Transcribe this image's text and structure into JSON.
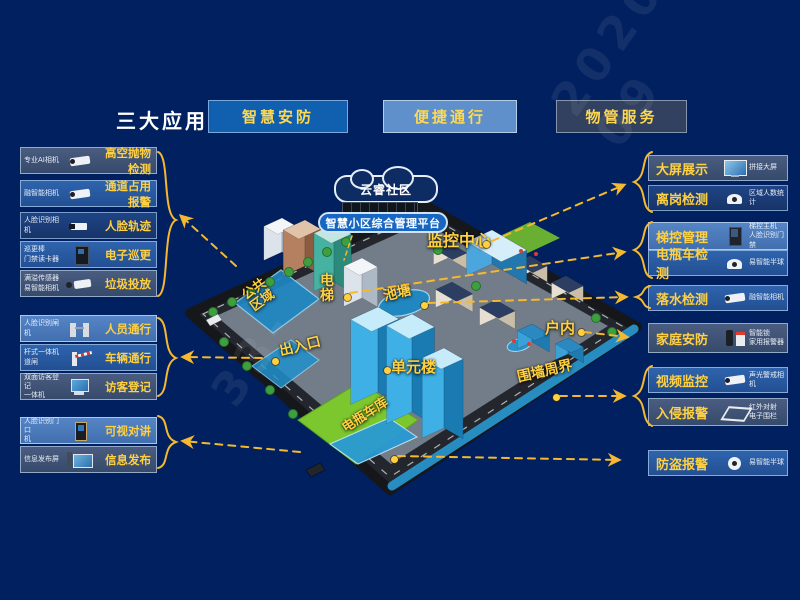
{
  "title": "三大应用",
  "buttons": [
    "智慧安防",
    "便捷通行",
    "物管服务"
  ],
  "left_items": [
    {
      "device": "专业AI相机",
      "label": "高空抛物检测",
      "icon": "bullet-camera"
    },
    {
      "device": "融智能相机",
      "label": "通道占用报警",
      "icon": "bullet-camera"
    },
    {
      "device": "人脸识别相机",
      "label": "人脸轨迹",
      "icon": "box-camera"
    },
    {
      "device": "巡更棒\n门禁读卡器",
      "label": "电子巡更",
      "icon": "card-reader"
    },
    {
      "device": "满溢传感器\n易智能相机",
      "label": "垃圾投放",
      "icon": "sensor-camera"
    },
    {
      "device": "人脸识别闸机",
      "label": "人员通行",
      "icon": "turnstile"
    },
    {
      "device": "杆式一体机\n道闸",
      "label": "车辆通行",
      "icon": "barrier-gate"
    },
    {
      "device": "双面访客登记\n一体机",
      "label": "访客登记",
      "icon": "visitor-terminal"
    },
    {
      "device": "人脸识别门口\n机",
      "label": "可视对讲",
      "icon": "door-station"
    },
    {
      "device": "信息发布屏",
      "label": "信息发布",
      "icon": "info-screen"
    }
  ],
  "right_items": [
    {
      "label": "大屏展示",
      "device": "拼接大屏",
      "icon": "video-wall"
    },
    {
      "label": "离岗检测",
      "device": "区域人数统计",
      "icon": "dome-camera"
    },
    {
      "label": "梯控管理",
      "device": "梯控主机\n人脸识别门禁",
      "icon": "access-panel"
    },
    {
      "label": "电瓶车检测",
      "device": "易智能半球",
      "icon": "dome-camera"
    },
    {
      "label": "落水检测",
      "device": "融智能相机",
      "icon": "bullet-camera"
    },
    {
      "label": "家庭安防",
      "device": "智能锁\n家用报警器",
      "icon": "smart-lock"
    },
    {
      "label": "视频监控",
      "device": "声光警戒相机",
      "icon": "bullet-camera"
    },
    {
      "label": "入侵报警",
      "device": "红外对射\n电子围栏",
      "icon": "fence"
    },
    {
      "label": "防盗报警",
      "device": "易智能半球",
      "icon": "turret-camera"
    }
  ],
  "map": {
    "cloud_label": "云睿社区",
    "platform_label": "智慧小区综合管理平台",
    "zones": [
      {
        "key": "jk",
        "text": "监控中心"
      },
      {
        "key": "dt",
        "text": "电梯"
      },
      {
        "key": "ct",
        "text": "池塘"
      },
      {
        "key": "gg",
        "text": "公共\n区域"
      },
      {
        "key": "crk",
        "text": "出入口"
      },
      {
        "key": "dyl",
        "text": "单元楼"
      },
      {
        "key": "hn",
        "text": "户内"
      },
      {
        "key": "wq",
        "text": "围墙周界"
      },
      {
        "key": "dp",
        "text": "电瓶车库"
      }
    ]
  },
  "watermark": {
    "w1": "2020-09",
    "w2": "33-"
  },
  "colors": {
    "background": "#00205f",
    "accent_yellow": "#ffd040",
    "arrow_yellow": "#f5b82e",
    "button_blue": "#1160b0",
    "button_light_blue": "#6090cc",
    "button_dark": "#31415f"
  }
}
